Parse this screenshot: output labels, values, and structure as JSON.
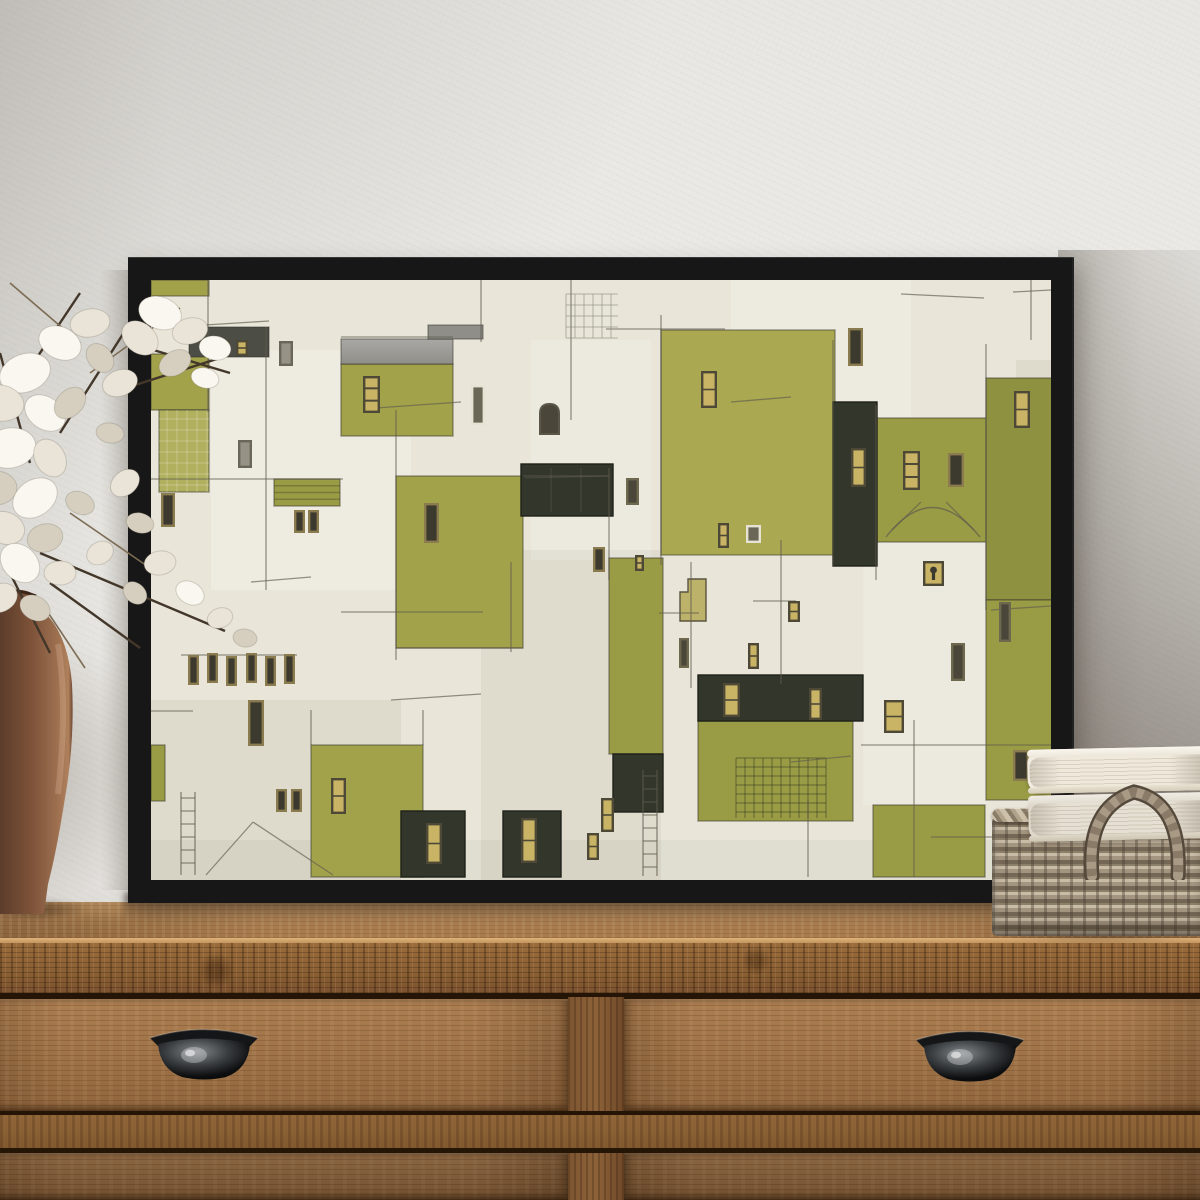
{
  "meta": {
    "alt": "Framed abstract olive-green and cream geometric village painting in a black floater frame, leaning on a rustic wooden dresser with black cup-pull drawers; terracotta vase with white lunaria flowers at left; white books stacked on a wicker basket at right."
  },
  "palette": {
    "wall": "#e9e8e4",
    "frame": "#171717",
    "cream": "#e9e6d9",
    "ink": "#5f5c4e",
    "o1": "#aaa951",
    "o2": "#9a9c45",
    "o3": "#8d9140",
    "o4": "#a2a24b",
    "o5": "#b0b05e",
    "gray_roof_a": "#a9a8a4",
    "gray_roof_b": "#8f8e89",
    "dark_roof": "#4c4d45",
    "charcoal": "#33362b",
    "gold": "#c9b465",
    "gold_frame": "#4e4836",
    "win_dark": "#4a473a",
    "win_dark_frame": "#6e684f",
    "darkgold_frame": "#8a7c4e",
    "darkgold_fill": "#3c392e",
    "white_frame": "#e6e2d4",
    "white_fill": "#6b6757",
    "wood_top": "#b08354",
    "wood_edge": "#8a5f33",
    "wood_drawer": "#9c7045",
    "vase": "#7c5138",
    "petal": "#faf7f1",
    "stem": "#43372a",
    "book": "#f1ece1",
    "basket": "#a3957f",
    "handle_metal": "#2a2d2f"
  },
  "painting": {
    "canvas": {
      "w": 900,
      "h": 600
    },
    "washes": [
      [
        60,
        70,
        200,
        240,
        "rgba(255,255,255,.22)"
      ],
      [
        330,
        270,
        180,
        330,
        "rgba(140,135,118,.10)"
      ],
      [
        0,
        420,
        250,
        180,
        "rgba(148,142,126,.12)"
      ],
      [
        580,
        0,
        180,
        140,
        "rgba(255,255,255,.18)"
      ],
      [
        712,
        262,
        123,
        263,
        "rgba(255,255,255,.14)"
      ],
      [
        380,
        60,
        120,
        220,
        "rgba(255,255,255,.15)"
      ],
      [
        865,
        80,
        38,
        440,
        "rgba(128,124,108,.10)"
      ],
      [
        0,
        560,
        900,
        40,
        "rgba(130,125,110,.08)"
      ]
    ],
    "greens": [
      [
        0,
        0,
        58,
        16,
        "o4",
        ""
      ],
      [
        0,
        74,
        58,
        56,
        "o4",
        ""
      ],
      [
        8,
        130,
        50,
        82,
        "o5",
        "grid"
      ],
      [
        190,
        84,
        112,
        72,
        "o4",
        ""
      ],
      [
        123,
        199,
        66,
        27,
        "o2",
        "stripes"
      ],
      [
        245,
        196,
        127,
        172,
        "o4",
        ""
      ],
      [
        510,
        50,
        174,
        225,
        "o1",
        ""
      ],
      [
        458,
        278,
        54,
        196,
        "o2",
        ""
      ],
      [
        547,
        441,
        155,
        100,
        "o2",
        "grid2"
      ],
      [
        725,
        138,
        112,
        124,
        "o2",
        "arch"
      ],
      [
        835,
        98,
        68,
        222,
        "o3",
        ""
      ],
      [
        835,
        320,
        68,
        200,
        "o2",
        ""
      ],
      [
        160,
        465,
        112,
        132,
        "o4",
        ""
      ],
      [
        0,
        465,
        14,
        56,
        "o2",
        ""
      ],
      [
        722,
        525,
        112,
        72,
        "o2",
        ""
      ]
    ],
    "roofs": [
      [
        190,
        59,
        112,
        25,
        "grad"
      ],
      [
        277,
        45,
        55,
        14,
        "flat"
      ],
      [
        38,
        47,
        80,
        30,
        "dark"
      ]
    ],
    "darks": [
      [
        682,
        122,
        44,
        164,
        ""
      ],
      [
        370,
        184,
        92,
        52,
        "panel"
      ],
      [
        547,
        395,
        165,
        46,
        ""
      ],
      [
        462,
        474,
        50,
        58,
        ""
      ],
      [
        250,
        531,
        64,
        66,
        ""
      ],
      [
        352,
        531,
        58,
        66,
        ""
      ]
    ],
    "steps_path": "M529,341 L529,312 L537,312 L537,299 L555,299 L555,341 Z",
    "windows": [
      [
        67,
        60,
        12,
        16,
        "gold"
      ],
      [
        85,
        60,
        12,
        16,
        "gold"
      ],
      [
        128,
        61,
        14,
        25,
        "sketch"
      ],
      [
        212,
        96,
        17,
        37,
        "gold3"
      ],
      [
        87,
        160,
        14,
        28,
        "sketch"
      ],
      [
        320,
        105,
        14,
        40,
        "white"
      ],
      [
        389,
        124,
        19,
        30,
        "arch"
      ],
      [
        143,
        230,
        11,
        23,
        "darkgold"
      ],
      [
        157,
        230,
        11,
        23,
        "darkgold"
      ],
      [
        10,
        213,
        14,
        34,
        "darkgold"
      ],
      [
        273,
        223,
        15,
        40,
        "darkgold"
      ],
      [
        475,
        198,
        13,
        27,
        "dark"
      ],
      [
        550,
        91,
        16,
        37,
        "gold"
      ],
      [
        697,
        48,
        15,
        38,
        "darkgold"
      ],
      [
        700,
        168,
        15,
        39,
        "gold"
      ],
      [
        752,
        171,
        17,
        39,
        "gold3"
      ],
      [
        797,
        173,
        16,
        34,
        "darkgold"
      ],
      [
        863,
        111,
        16,
        37,
        "gold"
      ],
      [
        848,
        322,
        12,
        40,
        "dark"
      ],
      [
        862,
        470,
        16,
        31,
        "darkgold"
      ],
      [
        733,
        420,
        20,
        33,
        "gold"
      ],
      [
        772,
        281,
        21,
        25,
        "keyhole"
      ],
      [
        800,
        363,
        14,
        38,
        "dark"
      ],
      [
        125,
        509,
        11,
        23,
        "darkgold"
      ],
      [
        140,
        509,
        11,
        23,
        "darkgold"
      ],
      [
        97,
        420,
        16,
        46,
        "darkgold"
      ],
      [
        180,
        498,
        15,
        36,
        "gold"
      ],
      [
        275,
        543,
        16,
        41,
        "gold"
      ],
      [
        370,
        538,
        16,
        45,
        "gold"
      ],
      [
        450,
        518,
        13,
        34,
        "gold"
      ],
      [
        436,
        553,
        12,
        27,
        "gold"
      ],
      [
        528,
        358,
        10,
        30,
        "dark"
      ],
      [
        597,
        363,
        11,
        26,
        "gold"
      ],
      [
        572,
        403,
        17,
        34,
        "gold"
      ],
      [
        658,
        408,
        13,
        32,
        "gold"
      ],
      [
        637,
        321,
        12,
        21,
        "gold"
      ],
      [
        567,
        243,
        11,
        25,
        "gold"
      ],
      [
        595,
        245,
        15,
        18,
        "white"
      ],
      [
        442,
        267,
        12,
        25,
        "darkgold"
      ],
      [
        484,
        275,
        9,
        16,
        "gold"
      ],
      [
        37,
        375,
        11,
        30,
        "darkgold"
      ],
      [
        56,
        373,
        11,
        30,
        "darkgold"
      ],
      [
        75,
        376,
        11,
        30,
        "darkgold"
      ],
      [
        95,
        373,
        11,
        30,
        "darkgold"
      ],
      [
        114,
        376,
        11,
        30,
        "darkgold"
      ],
      [
        133,
        374,
        11,
        30,
        "darkgold"
      ]
    ],
    "lines": [
      [
        57,
        0,
        57,
        132
      ],
      [
        115,
        47,
        115,
        310
      ],
      [
        245,
        130,
        245,
        380
      ],
      [
        330,
        0,
        330,
        62
      ],
      [
        420,
        0,
        420,
        140
      ],
      [
        458,
        188,
        458,
        300
      ],
      [
        510,
        35,
        510,
        285
      ],
      [
        540,
        282,
        540,
        408
      ],
      [
        630,
        260,
        630,
        404
      ],
      [
        682,
        60,
        682,
        286
      ],
      [
        725,
        125,
        725,
        300
      ],
      [
        835,
        64,
        835,
        330
      ],
      [
        763,
        440,
        763,
        597
      ],
      [
        657,
        520,
        657,
        597
      ],
      [
        880,
        0,
        880,
        60
      ],
      [
        360,
        282,
        360,
        372
      ],
      [
        0,
        199,
        192,
        199
      ],
      [
        30,
        375,
        146,
        375
      ],
      [
        0,
        431,
        42,
        431
      ],
      [
        190,
        332,
        332,
        332
      ],
      [
        455,
        49,
        574,
        49
      ],
      [
        508,
        333,
        548,
        333
      ],
      [
        710,
        465,
        900,
        465
      ],
      [
        780,
        557,
        900,
        557
      ],
      [
        602,
        321,
        645,
        321
      ],
      [
        750,
        14,
        833,
        18
      ],
      [
        862,
        12,
        900,
        10
      ],
      [
        38,
        46,
        118,
        41
      ],
      [
        190,
        57,
        302,
        57
      ],
      [
        55,
        595,
        102,
        542
      ],
      [
        102,
        542,
        182,
        595
      ],
      [
        225,
        128,
        310,
        122
      ],
      [
        240,
        420,
        330,
        414
      ],
      [
        580,
        122,
        640,
        117
      ],
      [
        100,
        302,
        160,
        297
      ],
      [
        640,
        482,
        700,
        476
      ],
      [
        840,
        330,
        900,
        326
      ],
      [
        372,
        196,
        458,
        196
      ],
      [
        245,
        368,
        372,
        368
      ],
      [
        160,
        465,
        160,
        430
      ],
      [
        272,
        465,
        272,
        430
      ]
    ],
    "ladders": [
      [
        492,
        490,
        14,
        106
      ],
      [
        30,
        512,
        14,
        83
      ]
    ],
    "lattice": {
      "x": 415,
      "y": 14,
      "w": 52,
      "h": 44
    },
    "arch": {
      "d": "M735,257 Q781,198 829,257",
      "l1": [
        741,
        250,
        770,
        222
      ],
      "l2": [
        823,
        250,
        795,
        222
      ]
    }
  },
  "flowers": {
    "shades": [
      "#faf7f1",
      "#eae4d8",
      "#d6cfc0"
    ],
    "petals": [
      [
        170,
        60,
        22,
        16,
        20,
        0
      ],
      [
        200,
        78,
        18,
        13,
        -15,
        1
      ],
      [
        225,
        95,
        16,
        12,
        10,
        0
      ],
      [
        150,
        85,
        20,
        15,
        40,
        1
      ],
      [
        185,
        110,
        17,
        12,
        -30,
        2
      ],
      [
        215,
        125,
        14,
        10,
        15,
        0
      ],
      [
        35,
        120,
        26,
        19,
        -20,
        0
      ],
      [
        10,
        150,
        24,
        18,
        10,
        1
      ],
      [
        55,
        160,
        22,
        16,
        35,
        0
      ],
      [
        20,
        195,
        26,
        20,
        -10,
        0
      ],
      [
        60,
        205,
        20,
        15,
        60,
        1
      ],
      [
        5,
        235,
        22,
        17,
        0,
        2
      ],
      [
        45,
        245,
        24,
        18,
        -35,
        0
      ],
      [
        15,
        275,
        20,
        16,
        20,
        1
      ],
      [
        55,
        285,
        18,
        14,
        -15,
        2
      ],
      [
        30,
        310,
        22,
        17,
        45,
        0
      ],
      [
        70,
        320,
        16,
        12,
        0,
        1
      ],
      [
        10,
        345,
        18,
        14,
        -25,
        1
      ],
      [
        45,
        355,
        16,
        12,
        30,
        2
      ],
      [
        80,
        150,
        18,
        13,
        -45,
        2
      ],
      [
        90,
        250,
        15,
        11,
        25,
        2
      ],
      [
        100,
        70,
        20,
        14,
        -10,
        1
      ],
      [
        70,
        90,
        22,
        16,
        25,
        0
      ],
      [
        110,
        105,
        16,
        12,
        50,
        2
      ],
      [
        130,
        130,
        18,
        13,
        -20,
        1
      ],
      [
        120,
        180,
        14,
        10,
        10,
        2
      ],
      [
        135,
        230,
        16,
        12,
        -40,
        1
      ],
      [
        150,
        270,
        14,
        10,
        15,
        2
      ],
      [
        170,
        310,
        16,
        12,
        -10,
        1
      ],
      [
        200,
        340,
        15,
        11,
        30,
        0
      ],
      [
        230,
        365,
        13,
        10,
        -20,
        1
      ],
      [
        255,
        385,
        12,
        9,
        10,
        2
      ],
      [
        145,
        340,
        13,
        10,
        40,
        2
      ],
      [
        110,
        300,
        14,
        11,
        -30,
        1
      ]
    ],
    "stems": [
      [
        60,
        330,
        150,
        395
      ],
      [
        50,
        300,
        235,
        378
      ],
      [
        80,
        260,
        160,
        315
      ],
      [
        40,
        210,
        10,
        100
      ],
      [
        70,
        180,
        140,
        70
      ],
      [
        100,
        120,
        190,
        55
      ],
      [
        120,
        140,
        230,
        105
      ],
      [
        30,
        130,
        90,
        40
      ],
      [
        55,
        355,
        95,
        415
      ],
      [
        20,
        320,
        60,
        400
      ],
      [
        140,
        90,
        240,
        120
      ],
      [
        90,
        90,
        20,
        30
      ]
    ]
  }
}
